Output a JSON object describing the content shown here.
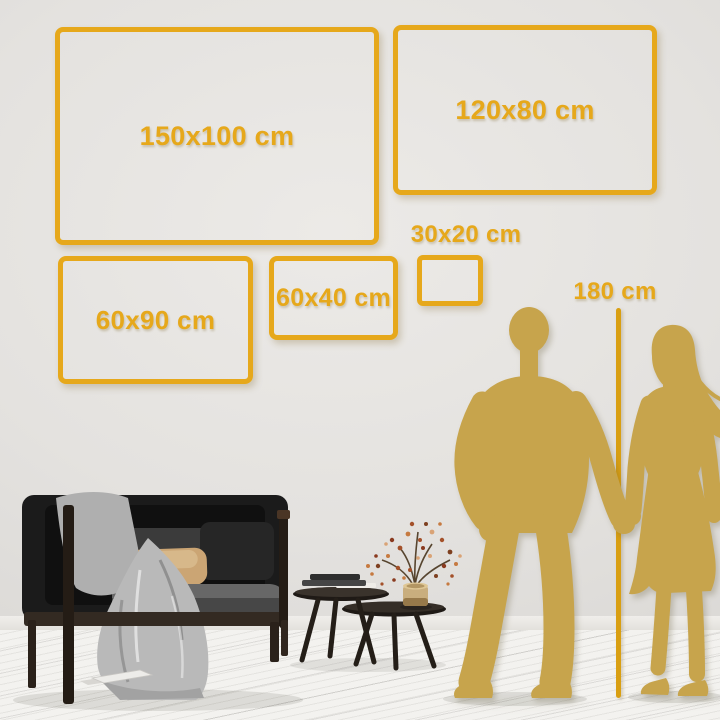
{
  "palette": {
    "accent_gold": "#E6A81B",
    "ruler_gold": "#D99F12",
    "figure_gold": "#C7A44C",
    "wall": "#E4E2DF",
    "floor": "#F3F2EF"
  },
  "frames": [
    {
      "label": "150x100 cm"
    },
    {
      "label": "120x80 cm"
    },
    {
      "label": "60x90 cm"
    },
    {
      "label": "60x40 cm"
    },
    {
      "label": "30x20 cm"
    }
  ],
  "height_marker": {
    "label": "180 cm"
  }
}
